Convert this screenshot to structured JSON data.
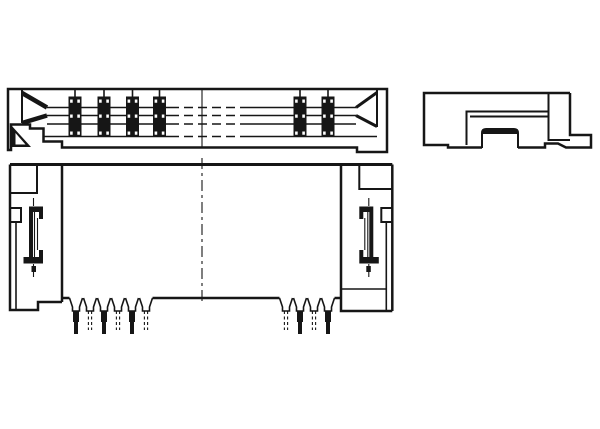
{
  "colors": {
    "background": "#ffffff",
    "ink": "#161616"
  },
  "views": {
    "top_view": {
      "name": "connector-side-section-view",
      "paths": {
        "outline": "M8,89 H387 V152 H357 V147.5 H62 V141.5 H43.5 V128.5 H30 V124.5 H11 V150 H8 Z",
        "left_wall": "M22,89 V123",
        "left_wedge": "M22,93 L47,107.5 M22,123 L47,115.5",
        "right_wall": "M377,89 V127",
        "right_wedge": "M377,92.5 L356,107.5 M377,126.5 L356,115.5",
        "slot_lines": "M47,107.5 H170 M240,107.5 H356 M47,115.5 H170 M240,115.5 H356 M47,124 H170 M240,124 H356 M44,136.5 H170 M240,136.5 H377",
        "break_lines": "M170,107.5 H240 M170,115.5 H240 M170,124 H240 M170,136.5 H240",
        "section_line": "M202,89 V147.5",
        "foot_triangle": "M11,125 L31,147 H11 Z",
        "foot_triangle_hole": "M15.5,133 L25.5,144.5 H15.5 Z"
      },
      "contact_bars": {
        "centers": [
          75,
          104,
          132.5,
          159.5,
          300,
          328
        ],
        "width": 13,
        "top": 96.5,
        "bottom": 136.5,
        "stem_top": 89,
        "dot_rows": [
          99.5,
          114.5,
          131.5
        ],
        "dot_w": 2.6,
        "dot_h": 3.2,
        "dot_dx": 3.6
      }
    },
    "end_view": {
      "name": "connector-end-view",
      "paths": {
        "outline": "M570,93 H424 V145 H448 V147.5 H482 M518,147.5 H545 V143.5 H558 L566,147.5 H591 V135 H570 V93",
        "inner_column": "M548.5,93 V140 H570",
        "cavity": "M548.5,111.5 H466.5 V145 M548.5,116.5 H470",
        "actuator_outline": "M482,148 V133 Q482,129 486,129 H514 Q518,129 518,133 V148",
        "actuator_cap": "M482.5,134 V132.5 Q482.5,129.5 486,129.5 H514 Q517.5,129.5 517.5,132.5 V134 Z"
      }
    },
    "front_view": {
      "name": "connector-front-view",
      "paths": {
        "top_edge": "M10,164.5 H392.3",
        "body_outline": "M10,164.5 V310 H38 V302 H62 M62,164.5 V302 M341,164.5 V298 M341,298 V311 H392.3 M392.3,164.5 V311",
        "bottom_edge_segments": "M62,298 H69.5 M152.5,298 H279.5 M334.5,298 H341",
        "recess_line": "M341,289 H386.3",
        "notch_left": "M37,164.5 V193 H10",
        "notch_right": "M359.3,164.5 V189 H392.3",
        "wing_inner_left": "M16,222 V310",
        "wing_inner_right": "M386.3,222 V311",
        "side_box_left": "M10,208 H21 V222 H10",
        "side_box_right": "M392.3,208 H381.3 V222 H392.3",
        "clip_left_strokes": "M34.5,212 V257 M37.5,218 V250",
        "clip_left_fills": "M29,206.5 H43 V212 H33 V263.5 H29 Z M39,212 H43 V219 H39 Z M23.5,257 H43 V263.5 H23.5 Z M39,250 H43 V257 H39 Z M31.5,266 H36 V272 H31.5 Z",
        "clip_left_ticks": "M33.5,198 V206 M33.5,264 V277",
        "clip_right_strokes": "M367.8,212 V257 M364.8,218 V250",
        "clip_right_fills": "M373.3,206.5 H359.3 V212 H369.3 V263.5 H373.3 Z M363.3,212 H359.3 V219 H363.3 Z M378.8,257 H359.3 V263.5 H378.8 Z M363.3,250 H359.3 V257 H363.3 Z M370.8,266 H366.3 V272 H370.8 Z",
        "clip_right_ticks": "M368.8,198 V206 M368.8,264 V277",
        "center_line": "M202,158 V305"
      },
      "pins": {
        "solid_centers": [
          76,
          104,
          132,
          300,
          328
        ],
        "hidden_centers": [
          90,
          118,
          146,
          286,
          314
        ],
        "shoulder": {
          "top_y": 298,
          "half_top": 6.5,
          "half_neck": 3.5,
          "neck_y": 307,
          "bottom_y": 311
        },
        "tail": {
          "top_y": 311,
          "mid_y": 322,
          "tip_y": 334,
          "half_w1": 3,
          "half_w2": 2
        },
        "hidden_tail": {
          "top_y": 311,
          "tip_y": 330,
          "half_w": 1.6
        }
      }
    }
  }
}
